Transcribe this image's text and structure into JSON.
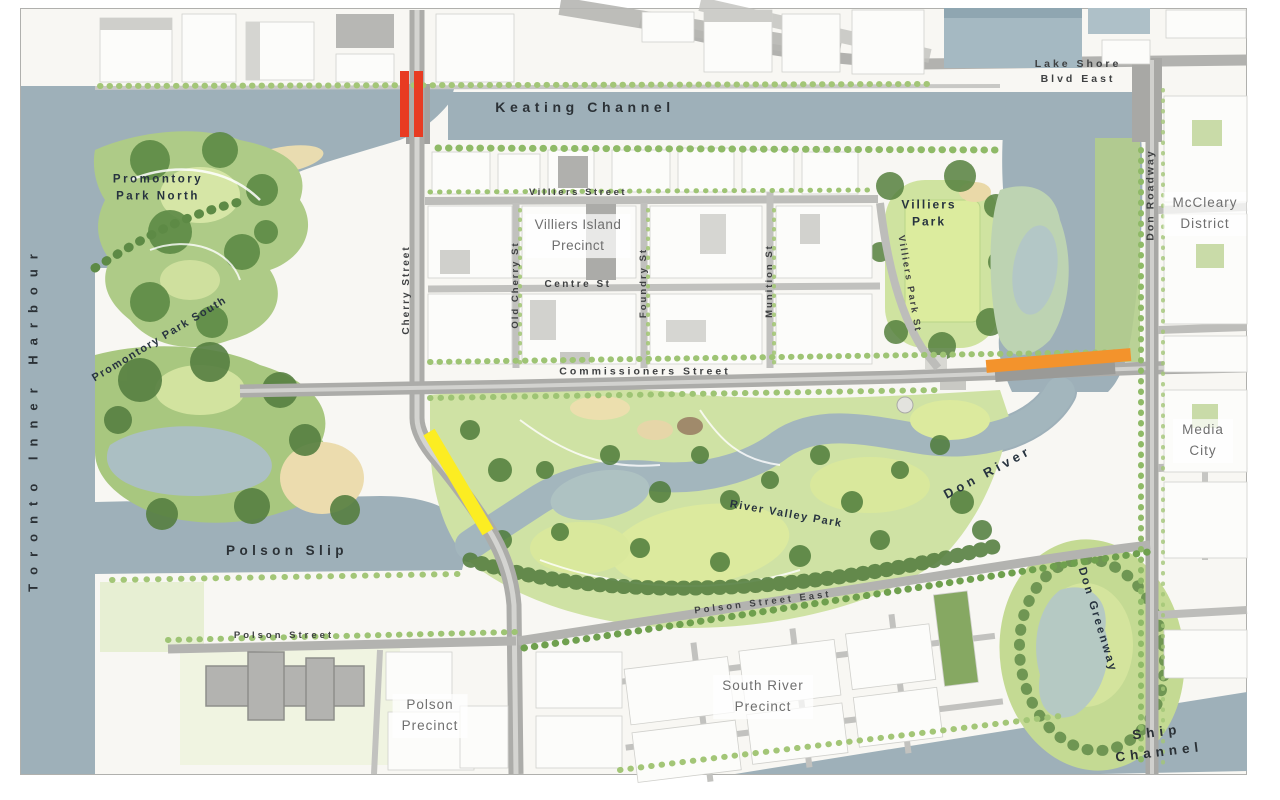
{
  "map": {
    "title": "Port Lands / Villiers Island plan map",
    "labels": {
      "toronto_inner_harbour": "Toronto Inner Harbour",
      "keating_channel": "Keating Channel",
      "lake_shore_blvd_east": "Lake Shore\nBlvd East",
      "promontory_park_north": "Promontory\nPark North",
      "promontory_park_south": "Promontory Park South",
      "villiers_street": "Villiers Street",
      "villiers_island_precinct": "Villiers Island\nPrecinct",
      "centre_st": "Centre St",
      "old_cherry_st": "Old Cherry St",
      "foundry_st": "Foundry St",
      "munition_st": "Munition St",
      "cherry_street": "Cherry Street",
      "villiers_park": "Villiers\nPark",
      "villiers_park_st": "Villiers Park St",
      "don_roadway": "Don Roadway",
      "mccleary_district": "McCleary\nDistrict",
      "commissioners_street": "Commissioners Street",
      "media_city": "Media\nCity",
      "don_river": "Don River",
      "river_valley_park": "River Valley Park",
      "polson_slip": "Polson Slip",
      "polson_street": "Polson Street",
      "polson_precinct": "Polson\nPrecinct",
      "polson_street_east": "Polson Street East",
      "south_river_precinct": "South River\nPrecinct",
      "don_greenway": "Don Greenway",
      "ship_channel": "Ship Channel"
    },
    "markers": {
      "red_bridge_note": "highlighted bridge segments at Cherry St / Keating Channel",
      "orange_bridge_note": "highlighted segment on Commissioners St at Don River",
      "yellow_bridge_note": "highlighted segment on Cherry St at Polson Slip"
    },
    "colors": {
      "water": "#9eb0b9",
      "land": "#f8f7f3",
      "park_light": "#cfe2a4",
      "park_mid": "#a8c77f",
      "tree_dark": "#4f7c3b",
      "road": "#acaca9",
      "marker_red": "#e83b22",
      "marker_orange": "#f3932c",
      "marker_yellow": "#fced22"
    }
  }
}
